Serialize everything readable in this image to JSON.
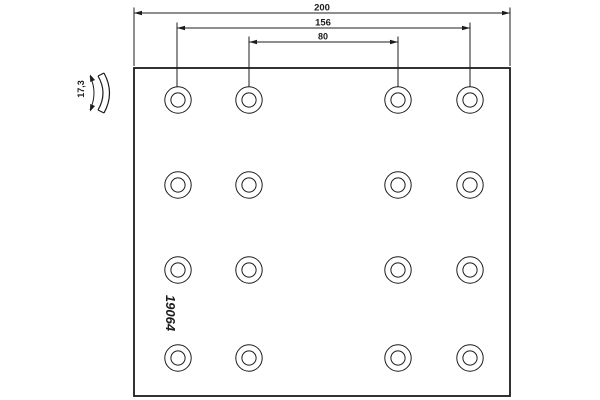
{
  "colors": {
    "background": "#ffffff",
    "ink": "#1c1c1c"
  },
  "labels": {
    "part_number": "19064",
    "thickness": "17,3",
    "dim_overall_width": "200",
    "dim_outer_hole_span": "156",
    "dim_inner_hole_span": "80"
  },
  "holes": {
    "cols_x": [
      178,
      249,
      398,
      470
    ],
    "rows_y": [
      100,
      185,
      270,
      358
    ],
    "outer_radius": 13.2,
    "inner_radius": 7.1
  }
}
